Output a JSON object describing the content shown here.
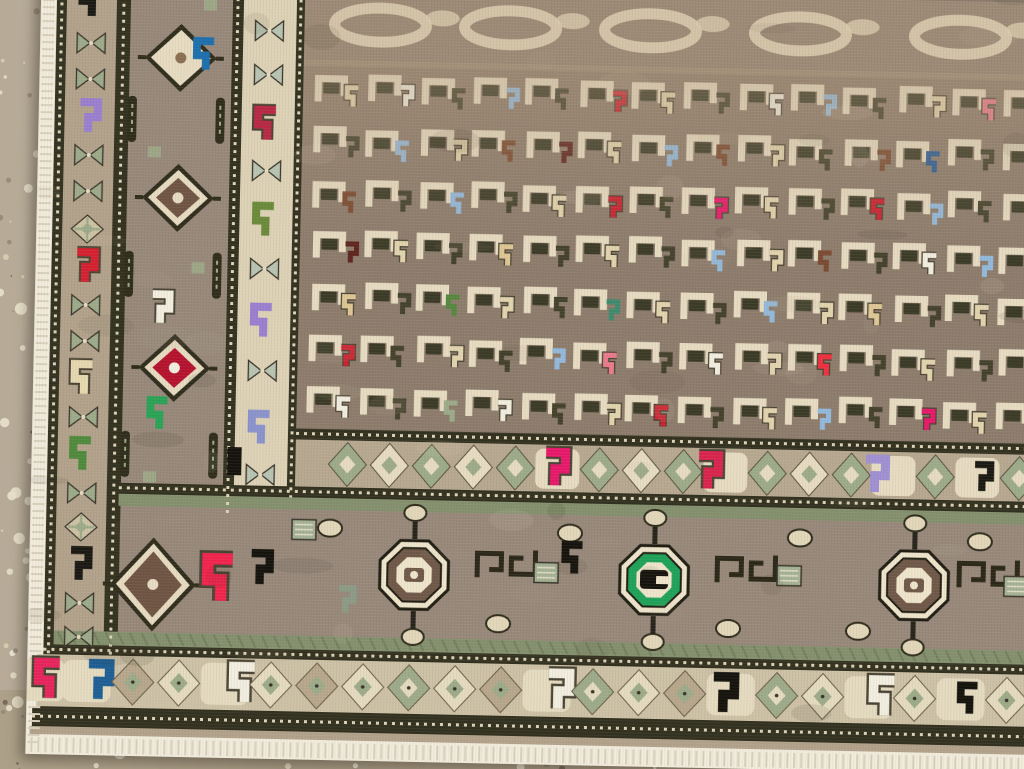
{
  "scene": {
    "width": 1024,
    "height": 769,
    "subject": "corner of a hand-knotted tribal rug lying on a speckled terrazzo floor"
  },
  "palette": {
    "fringe": "#f2ecdd",
    "dark": "#32301f",
    "bead": "#ddd3b6",
    "band_tan": "#b2a28b",
    "border_bg": "#97887a",
    "cream_bg": "#ddd2b6",
    "field_bg": "#8d7c6c",
    "cloud_bg": "#9c8a76",
    "cloud_loop": "#d8c9ac",
    "minor_bg": "#b7a890",
    "sage_stripe": "#84906e",
    "diam_bg": "#cdc1a6",
    "sage": "#9dab8a",
    "sage_pale": "#b9c4b2",
    "cream": "#e7dcc2",
    "brown": "#6f5443",
    "blob_dark": "#3a3a26",
    "offwhite": "#f2eee0",
    "green_ring": "#1ea258",
    "red_diamond": "#b5122e",
    "taupe_diamond": "#b7a78c"
  },
  "floor": {
    "seed": 7,
    "base": "#b2a693",
    "left_tint": "#bcb1a0",
    "bottom_tint": "#a4977c",
    "speckle_colors": [
      "#e8dfc8",
      "#d9cfb2",
      "#938673",
      "#6e6254",
      "#f2ecdc"
    ],
    "speckle_count": 800,
    "pebble_count": 60,
    "pebble_color": "#e9e1cb"
  },
  "layout": {
    "rug_w": 1160,
    "rug_h": 800,
    "rects": [
      {
        "n": "left-fringe",
        "x": 0,
        "y": 0,
        "w": 16,
        "h": 786,
        "c": "fringe"
      },
      {
        "n": "outer-guard",
        "x": 16,
        "y": 0,
        "w": 10,
        "h": 700,
        "c": "dark"
      },
      {
        "n": "bowtie-band",
        "x": 26,
        "y": 0,
        "w": 50,
        "h": 700,
        "c": "band_tan"
      },
      {
        "n": "guard-2",
        "x": 76,
        "y": 0,
        "w": 14,
        "h": 700,
        "c": "dark"
      },
      {
        "n": "main-border-left",
        "x": 90,
        "y": 0,
        "w": 102,
        "h": 551,
        "c": "border_bg"
      },
      {
        "n": "guard-3",
        "x": 192,
        "y": 0,
        "w": 11,
        "h": 560,
        "c": "dark"
      },
      {
        "n": "cream-border",
        "x": 203,
        "y": 0,
        "w": 53,
        "h": 538,
        "c": "cream_bg"
      },
      {
        "n": "guard-4",
        "x": 256,
        "y": 0,
        "w": 8,
        "h": 540,
        "c": "dark"
      },
      {
        "n": "field",
        "x": 264,
        "y": 0,
        "w": 896,
        "h": 478,
        "c": "field_bg"
      },
      {
        "n": "cloud-band",
        "x": 264,
        "y": 28,
        "w": 896,
        "h": 78,
        "c": "cloud_bg"
      },
      {
        "n": "minor-border-row",
        "x": 264,
        "y": 478,
        "w": 896,
        "h": 50,
        "c": "minor_bg"
      },
      {
        "n": "guard-5",
        "x": 264,
        "y": 469,
        "w": 896,
        "h": 11,
        "c": "dark"
      },
      {
        "n": "guard-6",
        "x": 88,
        "y": 527,
        "w": 1072,
        "h": 11,
        "c": "dark"
      },
      {
        "n": "sage-stripe-top",
        "x": 88,
        "y": 538,
        "w": 1072,
        "h": 12,
        "c": "sage_stripe"
      },
      {
        "n": "main-border-bottom",
        "x": 90,
        "y": 550,
        "w": 1070,
        "h": 126,
        "c": "border_bg"
      },
      {
        "n": "sage-stripe-bottom",
        "x": 26,
        "y": 676,
        "w": 1134,
        "h": 14,
        "c": "sage_stripe"
      },
      {
        "n": "guard-7",
        "x": 16,
        "y": 690,
        "w": 1144,
        "h": 10,
        "c": "dark"
      },
      {
        "n": "diamond-band",
        "x": 10,
        "y": 700,
        "w": 1150,
        "h": 52,
        "c": "diam_bg"
      },
      {
        "n": "outer-dark-band",
        "x": 6,
        "y": 752,
        "w": 1154,
        "h": 20,
        "c": "dark"
      },
      {
        "n": "edge-tan-line",
        "x": 4,
        "y": 772,
        "w": 1156,
        "h": 8,
        "c": "band_tan"
      },
      {
        "n": "bottom-fringe",
        "x": 0,
        "y": 780,
        "w": 1160,
        "h": 20,
        "c": "fringe"
      }
    ],
    "bead_lines": [
      {
        "x1": 21,
        "y1": 0,
        "x2": 21,
        "y2": 700
      },
      {
        "x1": 83,
        "y1": 0,
        "x2": 83,
        "y2": 700
      },
      {
        "x1": 197,
        "y1": 0,
        "x2": 197,
        "y2": 558
      },
      {
        "x1": 260,
        "y1": 0,
        "x2": 260,
        "y2": 538
      },
      {
        "x1": 264,
        "y1": 474,
        "x2": 1160,
        "y2": 474
      },
      {
        "x1": 88,
        "y1": 532,
        "x2": 1160,
        "y2": 532
      },
      {
        "x1": 16,
        "y1": 695,
        "x2": 1160,
        "y2": 695
      },
      {
        "x1": 6,
        "y1": 762,
        "x2": 1160,
        "y2": 762
      }
    ]
  },
  "bowtie_band": {
    "cx": 51,
    "motifs": [
      {
        "y": 46,
        "t": "hook",
        "c": "#1a1812"
      },
      {
        "y": 88,
        "t": "bow"
      },
      {
        "y": 124,
        "t": "bow"
      },
      {
        "y": 162,
        "t": "hook",
        "c": "#9a7fd0"
      },
      {
        "y": 200,
        "t": "bow"
      },
      {
        "y": 236,
        "t": "bow"
      },
      {
        "y": 274,
        "t": "lat"
      },
      {
        "y": 312,
        "t": "hook",
        "c": "#d62030"
      },
      {
        "y": 350,
        "t": "bow"
      },
      {
        "y": 386,
        "t": "bow"
      },
      {
        "y": 424,
        "t": "hook",
        "c": "#e6d8b0"
      },
      {
        "y": 462,
        "t": "bow"
      },
      {
        "y": 500,
        "t": "hook",
        "c": "#4f8a3c"
      },
      {
        "y": 538,
        "t": "bow"
      },
      {
        "y": 572,
        "t": "lat"
      },
      {
        "y": 610,
        "t": "hook",
        "c": "#1a1812"
      },
      {
        "y": 648,
        "t": "bow"
      },
      {
        "y": 682,
        "t": "bow"
      }
    ]
  },
  "main_border_left": {
    "medallions": [
      {
        "cx": 141,
        "cy": 101,
        "core": "#e7dcc2",
        "dot": "#8a6f52"
      },
      {
        "cx": 141,
        "cy": 241,
        "core": "#6f5443",
        "dot": "#e7dcc2"
      },
      {
        "cx": 141,
        "cy": 411,
        "core": "#b5122e",
        "dot": "#f2eee0"
      }
    ],
    "hooks": [
      {
        "x": 166,
        "y": 98,
        "c": "#1d6fae",
        "s": 1.3
      },
      {
        "x": 127,
        "y": 352,
        "c": "#f2eee0",
        "s": 1.3
      },
      {
        "x": 127,
        "y": 458,
        "c": "#2aa356",
        "s": 1.3
      }
    ],
    "bars": {
      "xs": [
        93,
        181
      ],
      "ys": [
        140,
        295,
        475
      ]
    },
    "sage_bits": [
      {
        "x": 110,
        "y": 190
      },
      {
        "x": 156,
        "y": 305
      },
      {
        "x": 112,
        "y": 515
      },
      {
        "x": 163,
        "y": 42
      }
    ]
  },
  "cream_border": {
    "cx": 229,
    "motifs": [
      {
        "y": 72,
        "t": "bow"
      },
      {
        "y": 116,
        "t": "bow"
      },
      {
        "y": 166,
        "t": "hook",
        "c": "#b82844"
      },
      {
        "y": 212,
        "t": "bow"
      },
      {
        "y": 262,
        "t": "hook",
        "c": "#6b8a3a"
      },
      {
        "y": 310,
        "t": "bow"
      },
      {
        "y": 363,
        "t": "hook",
        "c": "#9a7fd0"
      },
      {
        "y": 412,
        "t": "bow"
      },
      {
        "y": 470,
        "t": "hook",
        "c": "#8a93cc"
      },
      {
        "y": 516,
        "t": "bow"
      }
    ]
  },
  "field": {
    "grid": {
      "ox": 272,
      "oy": 106,
      "dx": 53,
      "dy": 52,
      "cols": 14,
      "rows": 7
    },
    "cloud_loops": [
      340,
      470,
      610,
      760,
      920,
      1070
    ],
    "legend": {
      "c": "#e2d4ae",
      "w": "#f2eee0",
      "d": "#43412c",
      "l": "#93b9dc",
      "r": "#c9202f",
      "p": "#ea7a8c",
      "b": "#7a4a30",
      "m": "#5e241e",
      "n": "#2a5c96",
      "y": "#dfc794",
      "g": "#55883f",
      "t": "#3f8a6e",
      "u": "#9078c8",
      "v": "#a79ad8",
      "k": "#e8186a",
      "R": "#ef2f3e",
      "G": "#2aa356",
      "s": "#9cab8b",
      "o": "#6b6b3a"
    },
    "rows": [
      "cwdldrcdwldcpd",
      "dlcbmclbcdbndw",
      "bdldcrdkcdrldc",
      "mcdydcdlcbdwld",
      "ydgcdtcdlcydcr",
      "rdcdlpdwcRdcdb",
      "wdswdcrdcldkcd"
    ]
  },
  "minor_row": {
    "cy": 504,
    "x0": 316,
    "step": 42,
    "rx": 19,
    "ry": 22,
    "black_rect": {
      "x": 196,
      "y": 489,
      "w": 14,
      "h": 28
    },
    "hooks": [
      {
        "x": 525,
        "c": "#e8186a"
      },
      {
        "x": 678,
        "c": "#d9244e"
      },
      {
        "x": 845,
        "c": "#a090d4"
      },
      {
        "x": 952,
        "c": "#1a1812",
        "s": 0.8
      }
    ]
  },
  "main_border_bottom": {
    "cy": 613,
    "octagons": [
      {
        "cx": 385,
        "ring": "#6f5848",
        "blob": "small"
      },
      {
        "cx": 625,
        "ring": "#1ea258",
        "blob": "big"
      },
      {
        "cx": 885,
        "ring": "#6f5848",
        "blob": "small"
      }
    ],
    "corner_diamond": {
      "cx": 124,
      "cy": 628
    },
    "hooks": [
      {
        "x": 192,
        "y": 622,
        "c": "#f2244e",
        "s": 1.9
      },
      {
        "x": 232,
        "y": 610,
        "c": "#14120c",
        "s": 1.4
      },
      {
        "x": 545,
        "y": 594,
        "c": "#14120c",
        "s": 1.3
      },
      {
        "x": 318,
        "y": 640,
        "c": "#8c9a86",
        "s": 1.1
      }
    ],
    "meanders": [
      448,
      688,
      930
    ],
    "sage_blocks": [
      {
        "x": 505,
        "y": 598
      },
      {
        "x": 748,
        "y": 596
      },
      {
        "x": 975,
        "y": 602
      },
      {
        "x": 262,
        "y": 560
      }
    ],
    "balls": [
      300,
      470,
      540,
      700,
      770,
      830,
      950,
      1020,
      1090,
      1135
    ]
  },
  "diamond_band": {
    "cy": 726,
    "x0": 14,
    "step": 46,
    "rx": 21,
    "ry": 23,
    "fills": [
      "#9dab8a",
      "#e5dbc0",
      "#b7a78c",
      "#e5dbc0"
    ],
    "hooks": [
      {
        "x": 23,
        "c": "#e8245c"
      },
      {
        "x": 73,
        "c": "#1d5f94"
      },
      {
        "x": 218,
        "c": "#f2eee0"
      },
      {
        "x": 533,
        "c": "#f2eee0"
      },
      {
        "x": 698,
        "c": "#14120c"
      },
      {
        "x": 858,
        "c": "#f2eee0"
      },
      {
        "x": 943,
        "c": "#14120c",
        "s": 0.8
      }
    ]
  }
}
